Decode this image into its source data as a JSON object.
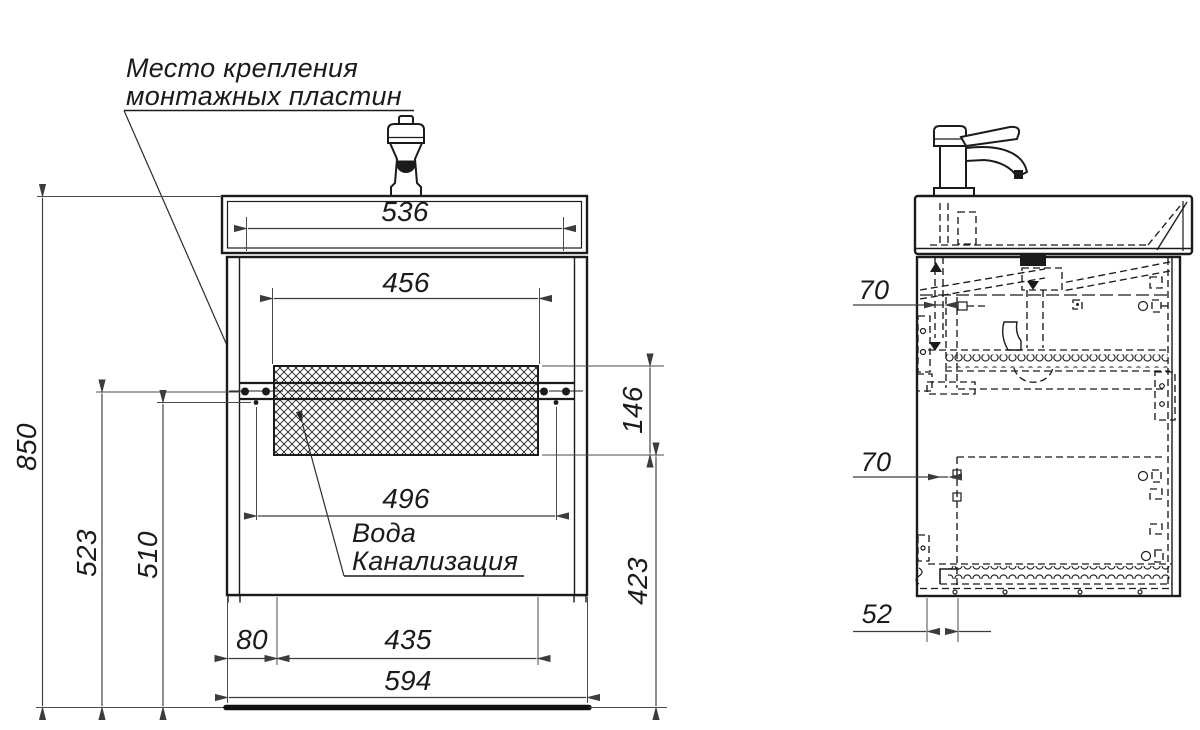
{
  "note": {
    "line1": "Место крепления",
    "line2": "монтажных пластин"
  },
  "utilities": {
    "line1": "Вода",
    "line2": "Канализация"
  },
  "dims": {
    "sink_top_width": "536",
    "opening_width": "456",
    "plate_span": "496",
    "total_height": "850",
    "plate_height_outer": "523",
    "plate_height_inner": "510",
    "service_zone_height": "146",
    "under_cabinet_height": "423",
    "left_offset": "80",
    "service_zone_width": "435",
    "overall_width": "594",
    "side_top_inset": "70",
    "side_bottom_inset": "70",
    "back_offset": "52"
  },
  "colors": {
    "line": "#1b1b1b",
    "dimension": "#3c3c3c",
    "background": "#ffffff"
  }
}
